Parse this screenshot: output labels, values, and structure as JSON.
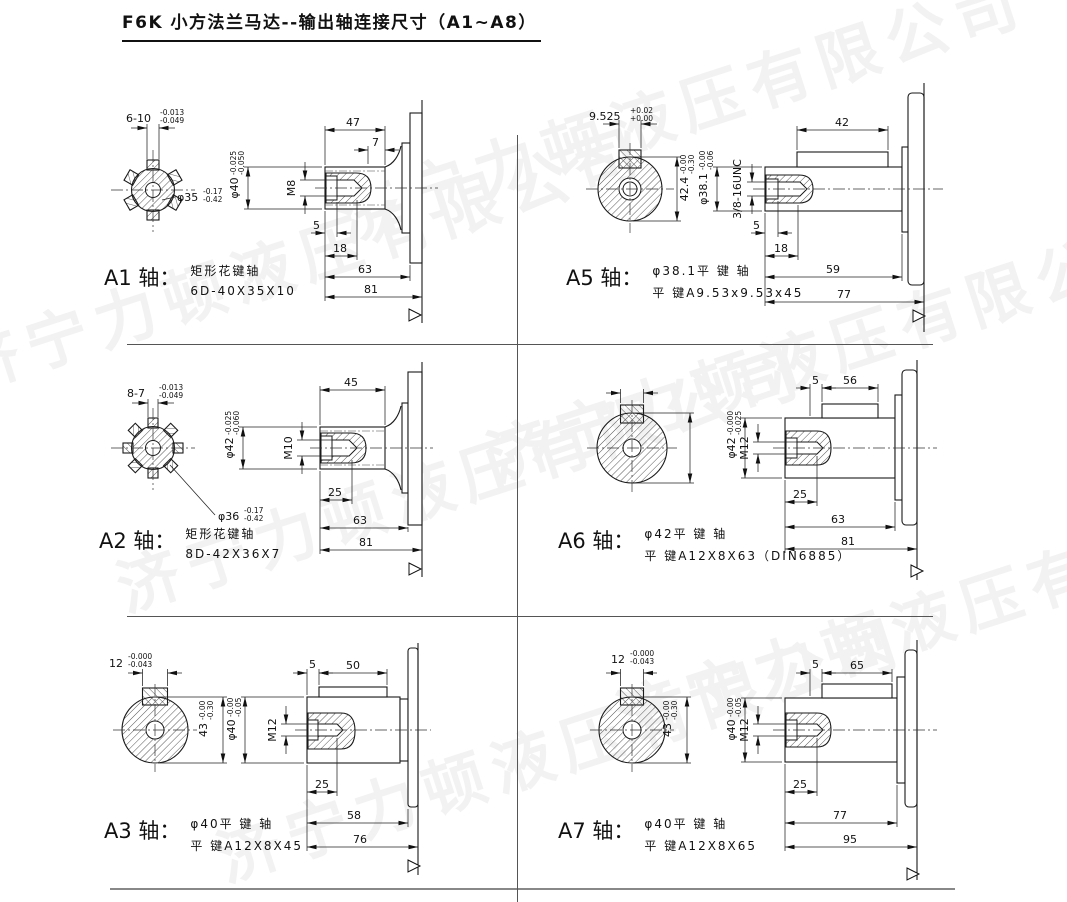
{
  "title": "F6K 小方法兰马达--输出轴连接尺寸（A1~A8）",
  "watermark": {
    "text": "济宁力顿液压有限公司",
    "color": "#f2f2f2"
  },
  "panels": {
    "a1": {
      "name": "A1 轴：",
      "desc1": "矩形花键轴",
      "desc2": "6D-40X35X10",
      "sw": "6-10",
      "swu": "-0.013",
      "swd": "-0.049",
      "sd": "φ35",
      "sdu": "-0.17",
      "sdd": "-0.42",
      "t1": "47",
      "t2": "7",
      "dia": "φ40",
      "diau": "-0.025",
      "diad": "-0.050",
      "thr": "M8",
      "b1": "5",
      "b2": "18",
      "b3": "63",
      "b4": "81"
    },
    "a2": {
      "name": "A2 轴：",
      "desc1": "矩形花键轴",
      "desc2": "8D-42X36X7",
      "sw": "8-7",
      "swu": "-0.013",
      "swd": "-0.049",
      "sd": "φ36",
      "sdu": "-0.17",
      "sdd": "-0.42",
      "t1": "45",
      "dia": "φ42",
      "diau": "-0.025",
      "diad": "-0.060",
      "thr": "M10",
      "b1": "25",
      "b2": "63",
      "b3": "81"
    },
    "a3": {
      "name": "A3 轴：",
      "desc1": "φ40平 键 轴",
      "desc2": "平 键A12X8X45",
      "kw": "12",
      "kwu": "-0.000",
      "kwd": "-0.043",
      "sh": "43",
      "shu": "-0.00",
      "shd": "-0.30",
      "t1": "5",
      "t2": "50",
      "dia": "φ40",
      "diau": "-0.00",
      "diad": "-0.05",
      "thr": "M12",
      "b1": "25",
      "b2": "58",
      "b3": "76"
    },
    "a5": {
      "name": "A5 轴：",
      "desc1": "φ38.1平 键 轴",
      "desc2": "平 键A9.53x9.53x45",
      "kw": "9.525",
      "kwu": "+0.02",
      "kwd": "+0.00",
      "sh": "42.4",
      "shu": "-0.00",
      "shd": "-0.30",
      "t1": "42",
      "dia": "φ38.1",
      "diau": "-0.00",
      "diad": "-0.06",
      "thr": "3/8-16UNC",
      "b1": "5",
      "b2": "18",
      "b3": "59",
      "b4": "77"
    },
    "a6": {
      "name": "A6 轴：",
      "desc1": "φ42平 键 轴",
      "desc2": "平 键A12X8X63（DIN6885）",
      "t1": "5",
      "t2": "56",
      "dia": "φ42",
      "diau": "-0.000",
      "diad": "-0.025",
      "thr": "M12",
      "b1": "25",
      "b2": "63",
      "b3": "81"
    },
    "a7": {
      "name": "A7 轴：",
      "desc1": "φ40平 键 轴",
      "desc2": "平 键A12X8X65",
      "kw": "12",
      "kwu": "-0.000",
      "kwd": "-0.043",
      "sh": "43",
      "shu": "-0.00",
      "shd": "-0.30",
      "t1": "5",
      "t2": "65",
      "dia": "φ40",
      "diau": "-0.00",
      "diad": "-0.05",
      "thr": "M12",
      "b1": "25",
      "b2": "77",
      "b3": "95"
    }
  }
}
